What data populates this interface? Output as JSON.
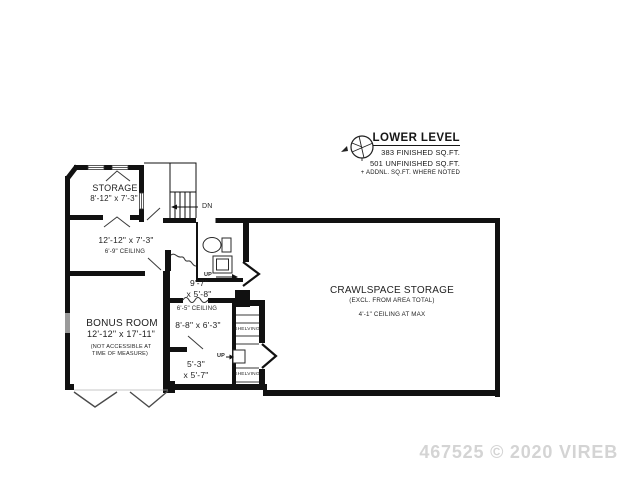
{
  "title_block": {
    "title": "LOWER LEVEL",
    "finished": "383 FINISHED SQ.FT.",
    "unfinished": "501 UNFINISHED SQ.FT.",
    "addnl_note": "+ ADDNL. SQ.FT. WHERE NOTED"
  },
  "rooms": {
    "storage": {
      "name": "STORAGE",
      "dims": "8'-12\" x 7'-3\""
    },
    "utility": {
      "dims": "12'-12\" x 7'-3\"",
      "ceiling": "6'-9\" CEILING"
    },
    "bonus": {
      "name": "BONUS ROOM",
      "dims": "12'-12\" x 17'-11\"",
      "note_line1": "(NOT ACCESSIBLE AT",
      "note_line2": "TIME OF MEASURE)"
    },
    "hall": {
      "dims_line1": "9'-7\"",
      "dims_line2": "x 5'-8\"",
      "up_label": "UP"
    },
    "room_6_5": {
      "ceiling": "6'-5\" CEILING",
      "dims": "8'-8\" x 6'-3\""
    },
    "room_5_3": {
      "dims_line1": "5'-3\"",
      "dims_line2": "x 5'-7\"",
      "up_label": "UP"
    },
    "shelving_upper": {
      "label": "SHELVING"
    },
    "shelving_lower": {
      "label": "SHELVING"
    },
    "crawlspace": {
      "name": "CRAWLSPACE STORAGE",
      "note": "(EXCL. FROM AREA TOTAL)",
      "ceiling": "4'-1\" CEILING AT MAX"
    }
  },
  "stairs": {
    "down_label": "DN"
  },
  "watermark": "467525 © 2020 VIREB",
  "colors": {
    "wall": "#111111",
    "text": "#1f1f1f",
    "watermark": "#d4d4d4",
    "window": "#9a9a9a",
    "background": "#ffffff"
  }
}
